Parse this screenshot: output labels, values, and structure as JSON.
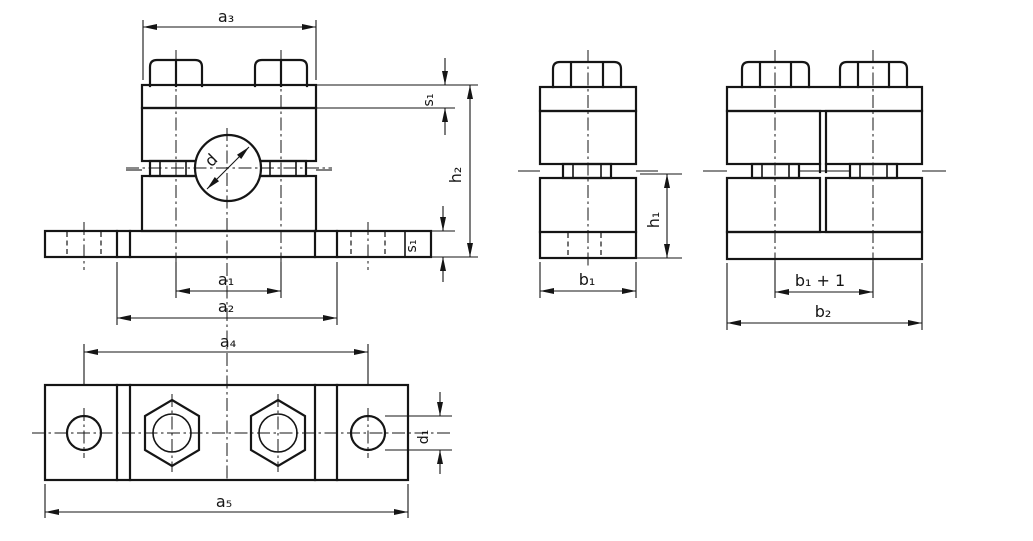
{
  "colors": {
    "line": "#151515",
    "background": "#ffffff"
  },
  "views": {
    "front": {
      "dims": {
        "a3": "a₃",
        "s1_top": "s₁",
        "h2": "h₂",
        "d": "d",
        "s1_bottom": "s₁",
        "a1": "a₁",
        "a2": "a₂",
        "a4": "a₄"
      }
    },
    "plan": {
      "dims": {
        "d1": "d₁",
        "a5": "a₅"
      }
    },
    "side_single": {
      "dims": {
        "b1": "b₁",
        "h1": "h₁"
      }
    },
    "side_double": {
      "dims": {
        "b1_plus_1": "b₁ + 1",
        "b2": "b₂"
      }
    }
  }
}
